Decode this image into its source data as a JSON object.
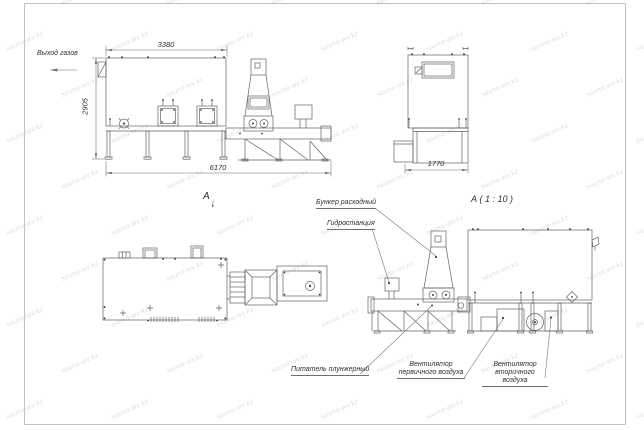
{
  "watermark": {
    "text": "sauna-wv.kz"
  },
  "labels": {
    "gas_outlet": "Выход газов",
    "view_a": "А",
    "detail_a": "А ( 1 : 10 )",
    "hopper": "Бункер расходный",
    "hydrostation": "Гидростанция",
    "plunger_feeder": "Питатель плунжерный",
    "fan_primary_l1": "Вентилятор",
    "fan_primary_l2": "первичного воздуха",
    "fan_secondary_l1": "Вентилятор",
    "fan_secondary_l2": "вторичного воздуха"
  },
  "dimensions": {
    "overall_width_top": "3380",
    "overall_height": "2905",
    "overall_length": "6170",
    "end_width": "1770"
  },
  "colors": {
    "line": "#5d6167",
    "dim": "#6a6e74",
    "text": "#2b2f33",
    "border": "#b3b3b3",
    "background": "#ffffff",
    "watermark": "#7d8a98"
  }
}
